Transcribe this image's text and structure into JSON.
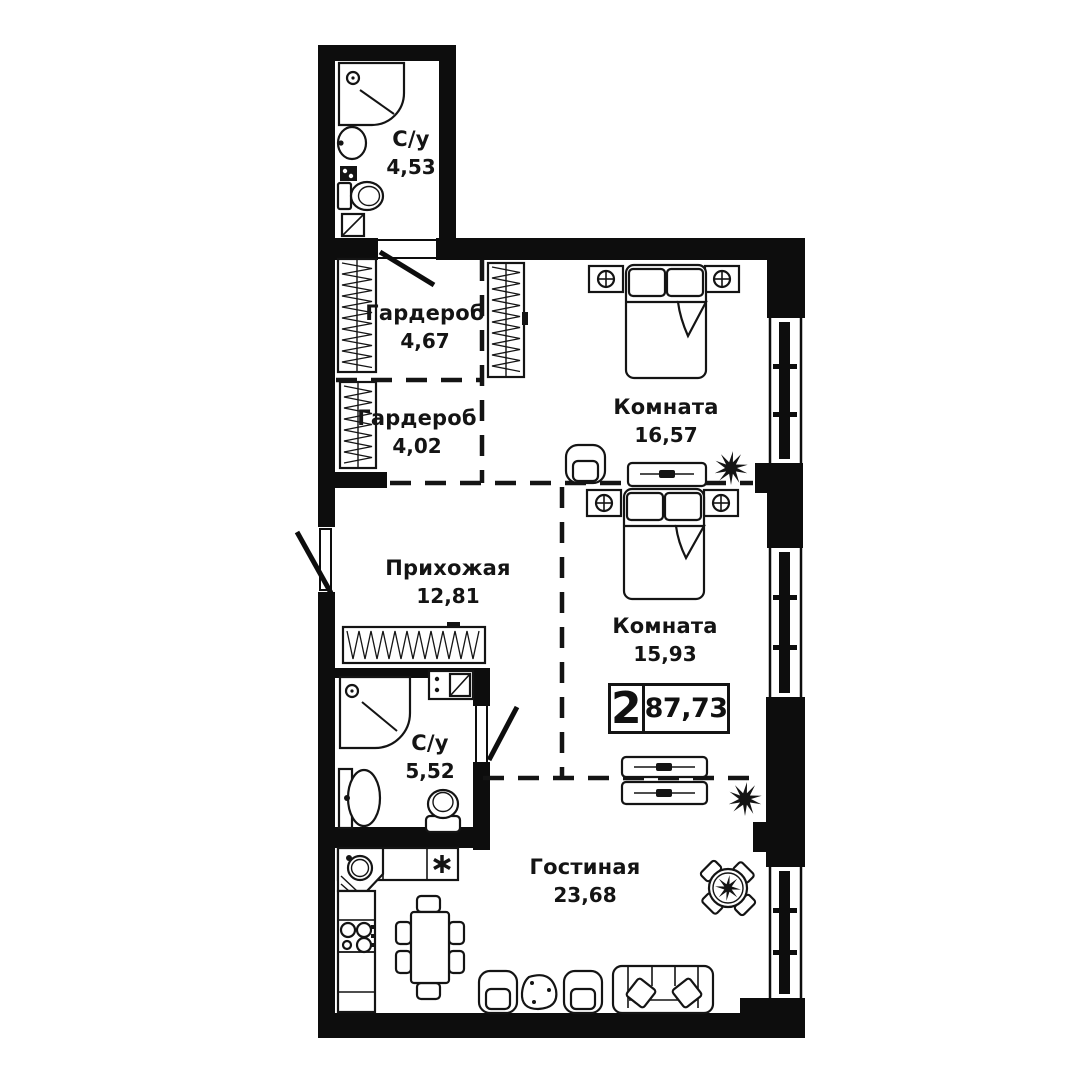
{
  "plan": {
    "type_badge": {
      "rooms_count": "2",
      "total_area": "87,73"
    },
    "rooms": [
      {
        "name": "С/у",
        "area": "4,53"
      },
      {
        "name": "Гардероб",
        "area": "4,67"
      },
      {
        "name": "Гардероб",
        "area": "4,02"
      },
      {
        "name": "Комната",
        "area": "16,57"
      },
      {
        "name": "Прихожая",
        "area": "12,81"
      },
      {
        "name": "Комната",
        "area": "15,93"
      },
      {
        "name": "С/у",
        "area": "5,52"
      },
      {
        "name": "Гостиная",
        "area": "23,68"
      }
    ]
  }
}
